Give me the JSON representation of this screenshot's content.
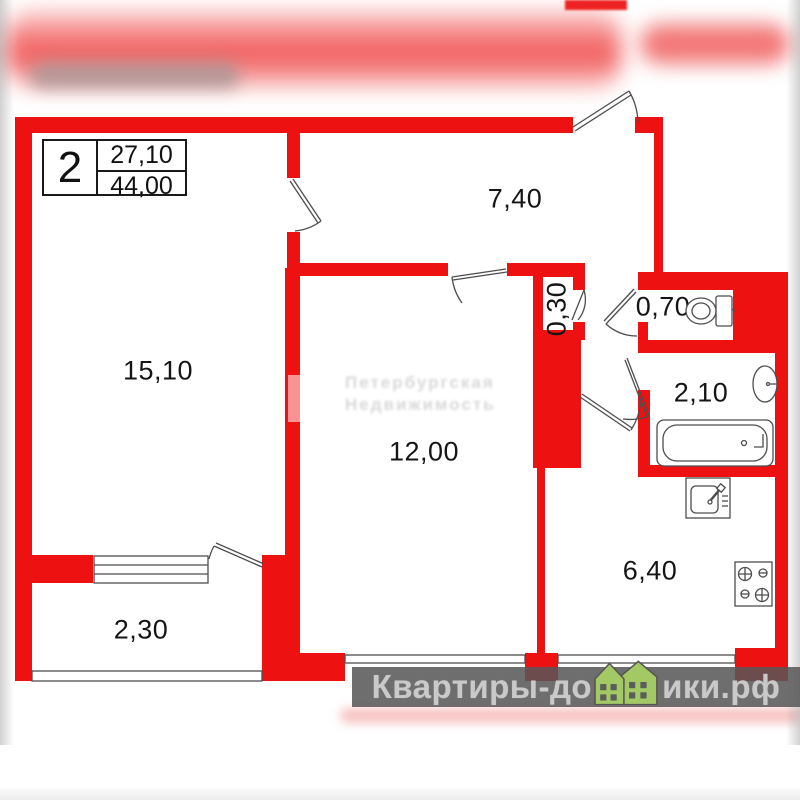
{
  "legend": {
    "unit_number": "2",
    "area_top": "27,10",
    "area_bottom": "44,00"
  },
  "rooms": [
    {
      "name": "living-room",
      "label": "15,10"
    },
    {
      "name": "hallway",
      "label": "7,40"
    },
    {
      "name": "storage",
      "label": "0,30"
    },
    {
      "name": "wc",
      "label": "0,70"
    },
    {
      "name": "bathroom",
      "label": "2,10"
    },
    {
      "name": "room-12",
      "label": "12,00"
    },
    {
      "name": "kitchen",
      "label": "6,40"
    },
    {
      "name": "balcony",
      "label": "2,30"
    }
  ],
  "watermarks": {
    "bottom": {
      "part1": "Квартиры-до",
      "part2": "ики.рф",
      "full_text": "Квартиры-домики.рф",
      "logo": "green-houses-icon"
    },
    "center": {
      "line1": "Петербургская",
      "line2": "Недвижимость"
    }
  },
  "fixtures": [
    "toilet-icon",
    "bathtub-icon",
    "sink-icon",
    "kitchen-sink-icon",
    "stove-icon"
  ],
  "colors": {
    "wall": "#ed1111",
    "linework": "#4d4d4d",
    "label_text": "#151515",
    "watermark_bar": "#565656",
    "watermark_text": "#c9c9c9",
    "logo_green": "#a3c964"
  }
}
